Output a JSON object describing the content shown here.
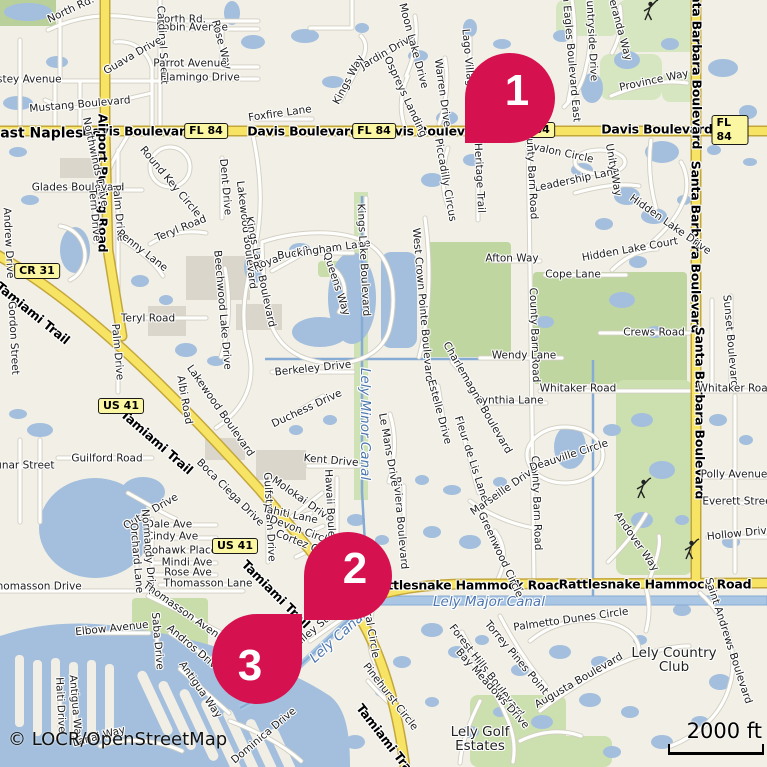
{
  "map": {
    "attribution": "© LOCR/OpenStreetMap",
    "scale_bar": {
      "label": "2000 ft"
    },
    "colors": {
      "marker": "#D6114F",
      "land": "#F1EFE6",
      "water": "#A3BFDD",
      "canal": "#86ABD4",
      "green": "#C8DDA9",
      "road_major_fill": "#F7E464",
      "road_major_casing": "#C4A73B",
      "badge_fill": "#FBF6A2"
    },
    "markers": [
      {
        "n": "1",
        "dir": "bl",
        "tip": [
          465,
          143
        ],
        "size": 90
      },
      {
        "n": "2",
        "dir": "bl",
        "tip": [
          304,
          620
        ],
        "size": 88
      },
      {
        "n": "3",
        "dir": "tr",
        "tip": [
          302,
          614
        ],
        "size": 90
      }
    ],
    "badges": [
      {
        "t": "FL 84",
        "x": 206,
        "y": 131
      },
      {
        "t": "FL 84",
        "x": 374,
        "y": 131
      },
      {
        "t": "FL 84",
        "x": 533,
        "y": 130
      },
      {
        "t": "FL 84",
        "x": 730,
        "y": 130
      },
      {
        "t": "US 41",
        "x": 121,
        "y": 406
      },
      {
        "t": "US 41",
        "x": 235,
        "y": 546
      },
      {
        "t": "CR 31",
        "x": 37,
        "y": 271
      }
    ],
    "labels": [
      {
        "t": "East Naples",
        "x": 37,
        "y": 134,
        "r": 0,
        "c": "T"
      },
      {
        "t": "Davis Boulevard",
        "x": 138,
        "y": 131,
        "r": 0,
        "c": "M"
      },
      {
        "t": "Davis Boulevard",
        "x": 303,
        "y": 131,
        "r": 0,
        "c": "M"
      },
      {
        "t": "Davis Boulevard",
        "x": 432,
        "y": 131,
        "r": 0,
        "c": "M"
      },
      {
        "t": "Davis Boulevard",
        "x": 657,
        "y": 129,
        "r": 0,
        "c": "M"
      },
      {
        "t": "Airport Pulling Road",
        "x": 103,
        "y": 183,
        "r": 90,
        "c": "M"
      },
      {
        "t": "Tamiami Trail",
        "x": 33,
        "y": 313,
        "r": 39,
        "c": "M"
      },
      {
        "t": "Tamiami Trail",
        "x": 157,
        "y": 442,
        "r": 41,
        "c": "M"
      },
      {
        "t": "Tamiami Trail",
        "x": 276,
        "y": 594,
        "r": 45,
        "c": "M"
      },
      {
        "t": "Tamiami Trail",
        "x": 387,
        "y": 741,
        "r": 52,
        "c": "M"
      },
      {
        "t": "Santa Barbara Boulevard",
        "x": 697,
        "y": 63,
        "r": 90,
        "c": "M"
      },
      {
        "t": "Santa Barbara Boulevard",
        "x": 696,
        "y": 247,
        "r": 90,
        "c": "M"
      },
      {
        "t": "Santa Barbara Boulevard",
        "x": 700,
        "y": 413,
        "r": 90,
        "c": "M"
      },
      {
        "t": "Rattlesnake Hammock Road",
        "x": 466,
        "y": 585,
        "r": 0,
        "c": "M"
      },
      {
        "t": "Rattlesnake Hammock Road",
        "x": 655,
        "y": 584,
        "r": 0,
        "c": "M"
      },
      {
        "t": "Lely Country Club",
        "x": 674,
        "y": 660,
        "r": 0,
        "c": "P",
        "w": 105
      },
      {
        "t": "Lely Golf Estates",
        "x": 480,
        "y": 739,
        "r": 0,
        "c": "P",
        "w": 80
      },
      {
        "t": "Lely Minor Canal",
        "x": 365,
        "y": 424,
        "r": 90,
        "c": "W"
      },
      {
        "t": "Lely Major Canal",
        "x": 489,
        "y": 602,
        "r": 0,
        "c": "W"
      },
      {
        "t": "Lely Canal",
        "x": 338,
        "y": 637,
        "r": -42,
        "c": "W"
      },
      {
        "t": "North Rd.",
        "x": 71,
        "y": 10,
        "r": -25
      },
      {
        "t": "North Rd.",
        "x": 181,
        "y": 20,
        "r": 0
      },
      {
        "t": "Robin Avenue",
        "x": 192,
        "y": 28,
        "r": 0
      },
      {
        "t": "Rose Way",
        "x": 221,
        "y": 45,
        "r": 75
      },
      {
        "t": "Cardinal Street",
        "x": 162,
        "y": 45,
        "r": 87
      },
      {
        "t": "Guava Drive",
        "x": 133,
        "y": 56,
        "r": -30
      },
      {
        "t": "Parrot Avenue",
        "x": 190,
        "y": 64,
        "r": 0
      },
      {
        "t": "Flamingo Drive",
        "x": 200,
        "y": 78,
        "r": 0
      },
      {
        "t": "Estey Avenue",
        "x": 26,
        "y": 80,
        "r": 0
      },
      {
        "t": "Mustang Boulevard",
        "x": 80,
        "y": 105,
        "r": -5
      },
      {
        "t": "Northwinds Drive",
        "x": 95,
        "y": 162,
        "r": 78
      },
      {
        "t": "Round Key Circle",
        "x": 170,
        "y": 182,
        "r": 50
      },
      {
        "t": "Dent Drive",
        "x": 225,
        "y": 187,
        "r": 85
      },
      {
        "t": "Glades Boulevard",
        "x": 78,
        "y": 188,
        "r": 0
      },
      {
        "t": "Palm Drive",
        "x": 118,
        "y": 213,
        "r": 85
      },
      {
        "t": "Tern Drive",
        "x": 94,
        "y": 215,
        "r": 85
      },
      {
        "t": "Teryl Road",
        "x": 181,
        "y": 229,
        "r": -22
      },
      {
        "t": "Penny Lane",
        "x": 142,
        "y": 251,
        "r": 38
      },
      {
        "t": "Teryl Road",
        "x": 148,
        "y": 319,
        "r": 0
      },
      {
        "t": "Palm Drive",
        "x": 117,
        "y": 352,
        "r": 85
      },
      {
        "t": "Andrew Drive",
        "x": 8,
        "y": 243,
        "r": 87
      },
      {
        "t": "Gordon Street",
        "x": 13,
        "y": 338,
        "r": 87
      },
      {
        "t": "Lakewood Boulevard",
        "x": 246,
        "y": 235,
        "r": 83
      },
      {
        "t": "Beechwood Lake Drive",
        "x": 222,
        "y": 310,
        "r": 85
      },
      {
        "t": "Kings Lake Boulevard",
        "x": 260,
        "y": 272,
        "r": 78
      },
      {
        "t": "Royal Lane",
        "x": 281,
        "y": 258,
        "r": -20
      },
      {
        "t": "Buckingham Lane",
        "x": 324,
        "y": 250,
        "r": -8
      },
      {
        "t": "Queens Way",
        "x": 336,
        "y": 284,
        "r": 72
      },
      {
        "t": "Kings Lake Boulevard",
        "x": 363,
        "y": 260,
        "r": 87
      },
      {
        "t": "West Crown Pointe Boulevard",
        "x": 422,
        "y": 305,
        "r": 85
      },
      {
        "t": "Foxfire Lane",
        "x": 280,
        "y": 114,
        "r": -8
      },
      {
        "t": "Kings Way",
        "x": 349,
        "y": 80,
        "r": -62
      },
      {
        "t": "Jardin Drive",
        "x": 388,
        "y": 52,
        "r": -30
      },
      {
        "t": "Moon Lake Drive",
        "x": 413,
        "y": 46,
        "r": 75
      },
      {
        "t": "Ospreys Landing",
        "x": 405,
        "y": 97,
        "r": 65
      },
      {
        "t": "Warren Drive",
        "x": 442,
        "y": 93,
        "r": 82
      },
      {
        "t": "Lago Villagio Way",
        "x": 469,
        "y": 75,
        "r": 85
      },
      {
        "t": "Heritage Trail",
        "x": 479,
        "y": 178,
        "r": 87
      },
      {
        "t": "Piccadilly Circus",
        "x": 445,
        "y": 180,
        "r": 80
      },
      {
        "t": "Glen Eagles Boulevard East",
        "x": 570,
        "y": 50,
        "r": 85
      },
      {
        "t": "Countryside Drive",
        "x": 591,
        "y": 34,
        "r": 87
      },
      {
        "t": "Veranda Way",
        "x": 619,
        "y": 27,
        "r": 75
      },
      {
        "t": "Province Way",
        "x": 654,
        "y": 81,
        "r": -12
      },
      {
        "t": "Avalon Circle",
        "x": 560,
        "y": 153,
        "r": 12
      },
      {
        "t": "Leadership Lane",
        "x": 577,
        "y": 180,
        "r": -12
      },
      {
        "t": "Unity Way",
        "x": 613,
        "y": 170,
        "r": 80
      },
      {
        "t": "County Barn Road",
        "x": 531,
        "y": 172,
        "r": 87
      },
      {
        "t": "County Barn Road",
        "x": 534,
        "y": 335,
        "r": 88
      },
      {
        "t": "County Barn Road",
        "x": 536,
        "y": 503,
        "r": 88
      },
      {
        "t": "Hidden Lake Drive",
        "x": 670,
        "y": 225,
        "r": 35
      },
      {
        "t": "Hidden Lake Court",
        "x": 630,
        "y": 250,
        "r": -10
      },
      {
        "t": "Afton Way",
        "x": 512,
        "y": 259,
        "r": 0
      },
      {
        "t": "Cope Lane",
        "x": 573,
        "y": 275,
        "r": 0
      },
      {
        "t": "Crews Road",
        "x": 654,
        "y": 333,
        "r": 0
      },
      {
        "t": "Sunset Boulevard",
        "x": 730,
        "y": 341,
        "r": 85
      },
      {
        "t": "Wendy Lane",
        "x": 524,
        "y": 356,
        "r": 0
      },
      {
        "t": "Whitaker Road",
        "x": 578,
        "y": 389,
        "r": 0
      },
      {
        "t": "Whitaker Road",
        "x": 736,
        "y": 389,
        "r": 0
      },
      {
        "t": "Cynthia Lane",
        "x": 509,
        "y": 401,
        "r": 0
      },
      {
        "t": "Charlemagne Boulevard",
        "x": 477,
        "y": 398,
        "r": 60
      },
      {
        "t": "Estelle Drive",
        "x": 439,
        "y": 412,
        "r": 75
      },
      {
        "t": "Fleur de Lis Lane",
        "x": 471,
        "y": 459,
        "r": 72
      },
      {
        "t": "Marseille Drive",
        "x": 504,
        "y": 491,
        "r": -35
      },
      {
        "t": "Deauville Circle",
        "x": 569,
        "y": 456,
        "r": -18
      },
      {
        "t": "Polly Avenue",
        "x": 734,
        "y": 475,
        "r": 0
      },
      {
        "t": "Everett Street",
        "x": 739,
        "y": 502,
        "r": 0
      },
      {
        "t": "Hollow Drive",
        "x": 740,
        "y": 534,
        "r": -6
      },
      {
        "t": "Andover Way",
        "x": 636,
        "y": 542,
        "r": 55
      },
      {
        "t": "Albi Road",
        "x": 184,
        "y": 400,
        "r": 80
      },
      {
        "t": "Lakewood Boulevard",
        "x": 220,
        "y": 411,
        "r": 55
      },
      {
        "t": "Boca Ciega Drive",
        "x": 230,
        "y": 493,
        "r": 45
      },
      {
        "t": "Guilford Road",
        "x": 107,
        "y": 459,
        "r": 0
      },
      {
        "t": "Lunar Street",
        "x": 22,
        "y": 466,
        "r": 0
      },
      {
        "t": "Outer Drive",
        "x": 151,
        "y": 512,
        "r": -30
      },
      {
        "t": "Dale Ave",
        "x": 169,
        "y": 525,
        "r": 0
      },
      {
        "t": "Cindy Ave",
        "x": 172,
        "y": 537,
        "r": 0
      },
      {
        "t": "Mohawk Place",
        "x": 180,
        "y": 551,
        "r": 0
      },
      {
        "t": "Mindi Ave",
        "x": 187,
        "y": 563,
        "r": 0
      },
      {
        "t": "Rose Ave",
        "x": 188,
        "y": 573,
        "r": 0
      },
      {
        "t": "Thomasson Lane",
        "x": 208,
        "y": 584,
        "r": 0
      },
      {
        "t": "Normandy Drive",
        "x": 148,
        "y": 552,
        "r": 85
      },
      {
        "t": "Orchard Lane",
        "x": 136,
        "y": 558,
        "r": 85
      },
      {
        "t": "Thomasson Drive",
        "x": 36,
        "y": 587,
        "r": 0
      },
      {
        "t": "Thomasson Avenue",
        "x": 186,
        "y": 614,
        "r": 35
      },
      {
        "t": "Elbow Avenue",
        "x": 112,
        "y": 629,
        "r": -6
      },
      {
        "t": "Saba Drive",
        "x": 157,
        "y": 641,
        "r": 85
      },
      {
        "t": "Andros Drive",
        "x": 194,
        "y": 649,
        "r": 40
      },
      {
        "t": "Antigua Way",
        "x": 200,
        "y": 690,
        "r": 55
      },
      {
        "t": "Antigua Way",
        "x": 75,
        "y": 708,
        "r": 85
      },
      {
        "t": "Haiti Drive",
        "x": 60,
        "y": 705,
        "r": 87
      },
      {
        "t": "Lanai Way",
        "x": 99,
        "y": 737,
        "r": -15
      },
      {
        "t": "Dominica Drive",
        "x": 264,
        "y": 736,
        "r": -40
      },
      {
        "t": "Gulfstream Drive",
        "x": 269,
        "y": 517,
        "r": 87
      },
      {
        "t": "Molokai Drive",
        "x": 302,
        "y": 500,
        "r": 35
      },
      {
        "t": "Tahiti Lane",
        "x": 290,
        "y": 515,
        "r": 12
      },
      {
        "t": "Devon Circle",
        "x": 301,
        "y": 531,
        "r": 20
      },
      {
        "t": "Cortez Circle",
        "x": 307,
        "y": 546,
        "r": 22
      },
      {
        "t": "Hawaii Boulevard",
        "x": 330,
        "y": 515,
        "r": 87
      },
      {
        "t": "Riviera Boulevard",
        "x": 400,
        "y": 523,
        "r": 85
      },
      {
        "t": "Kent Drive",
        "x": 331,
        "y": 461,
        "r": 5
      },
      {
        "t": "Duchess Drive",
        "x": 307,
        "y": 409,
        "r": -25
      },
      {
        "t": "Berkeley Drive",
        "x": 313,
        "y": 369,
        "r": -6
      },
      {
        "t": "Le Mans Drive",
        "x": 388,
        "y": 450,
        "r": 80
      },
      {
        "t": "Valley Stream",
        "x": 320,
        "y": 625,
        "r": -40
      },
      {
        "t": "Doral Circle",
        "x": 370,
        "y": 628,
        "r": 80
      },
      {
        "t": "Greenwood Circle",
        "x": 500,
        "y": 555,
        "r": 65
      },
      {
        "t": "Forest Hills Boulevard",
        "x": 486,
        "y": 671,
        "r": 52
      },
      {
        "t": "Bay Meadows Drive",
        "x": 492,
        "y": 689,
        "r": 48
      },
      {
        "t": "Torrey Pines Point",
        "x": 516,
        "y": 658,
        "r": 50
      },
      {
        "t": "Palmetto Dunes Circle",
        "x": 571,
        "y": 620,
        "r": -8
      },
      {
        "t": "Augusta Boulevard",
        "x": 579,
        "y": 681,
        "r": -30
      },
      {
        "t": "Pinehurst Circle",
        "x": 390,
        "y": 697,
        "r": 52
      },
      {
        "t": "Saint Andrews Boulevard",
        "x": 728,
        "y": 641,
        "r": 72
      }
    ]
  }
}
